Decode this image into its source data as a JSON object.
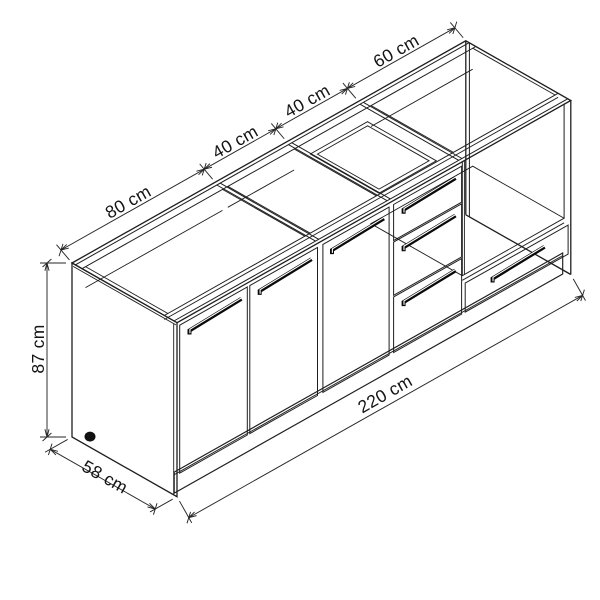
{
  "diagram": {
    "type": "isometric dimension drawing",
    "subject": "kitchen base cabinet unit",
    "units": "cm",
    "dims": {
      "sections": [
        {
          "id": "section-80",
          "label": "80 cm",
          "cm": 80
        },
        {
          "id": "section-40a",
          "label": "40 cm",
          "cm": 40
        },
        {
          "id": "section-40b",
          "label": "40 cm",
          "cm": 40
        },
        {
          "id": "section-60",
          "label": "60 cm",
          "cm": 60
        }
      ],
      "height": {
        "label": "87 cm",
        "cm": 87
      },
      "depth": {
        "label": "58 cm",
        "cm": 58
      },
      "total_width": {
        "label": "220 cm",
        "cm": 220
      }
    },
    "structure": {
      "sections": [
        {
          "width_cm": 80,
          "front": "two hinged doors with bar handles",
          "top": "open carcass"
        },
        {
          "width_cm": 40,
          "front": "single hinged door with bar handle",
          "top": "open carcass"
        },
        {
          "width_cm": 40,
          "front": "three drawers with bar handles",
          "top": "open drawer box"
        },
        {
          "width_cm": 60,
          "front": "open appliance cavity with bottom drawer",
          "top": "open carcass"
        }
      ],
      "drawer_count_mid_section": 3,
      "plinth": "full-width toe kick",
      "foot": "round adjustable leg at rear left"
    },
    "colors": {
      "line": "#1e1e1e",
      "dimension": "#262626",
      "text": "#141414",
      "handle": "#0a0a0a",
      "background": "#ffffff"
    }
  }
}
